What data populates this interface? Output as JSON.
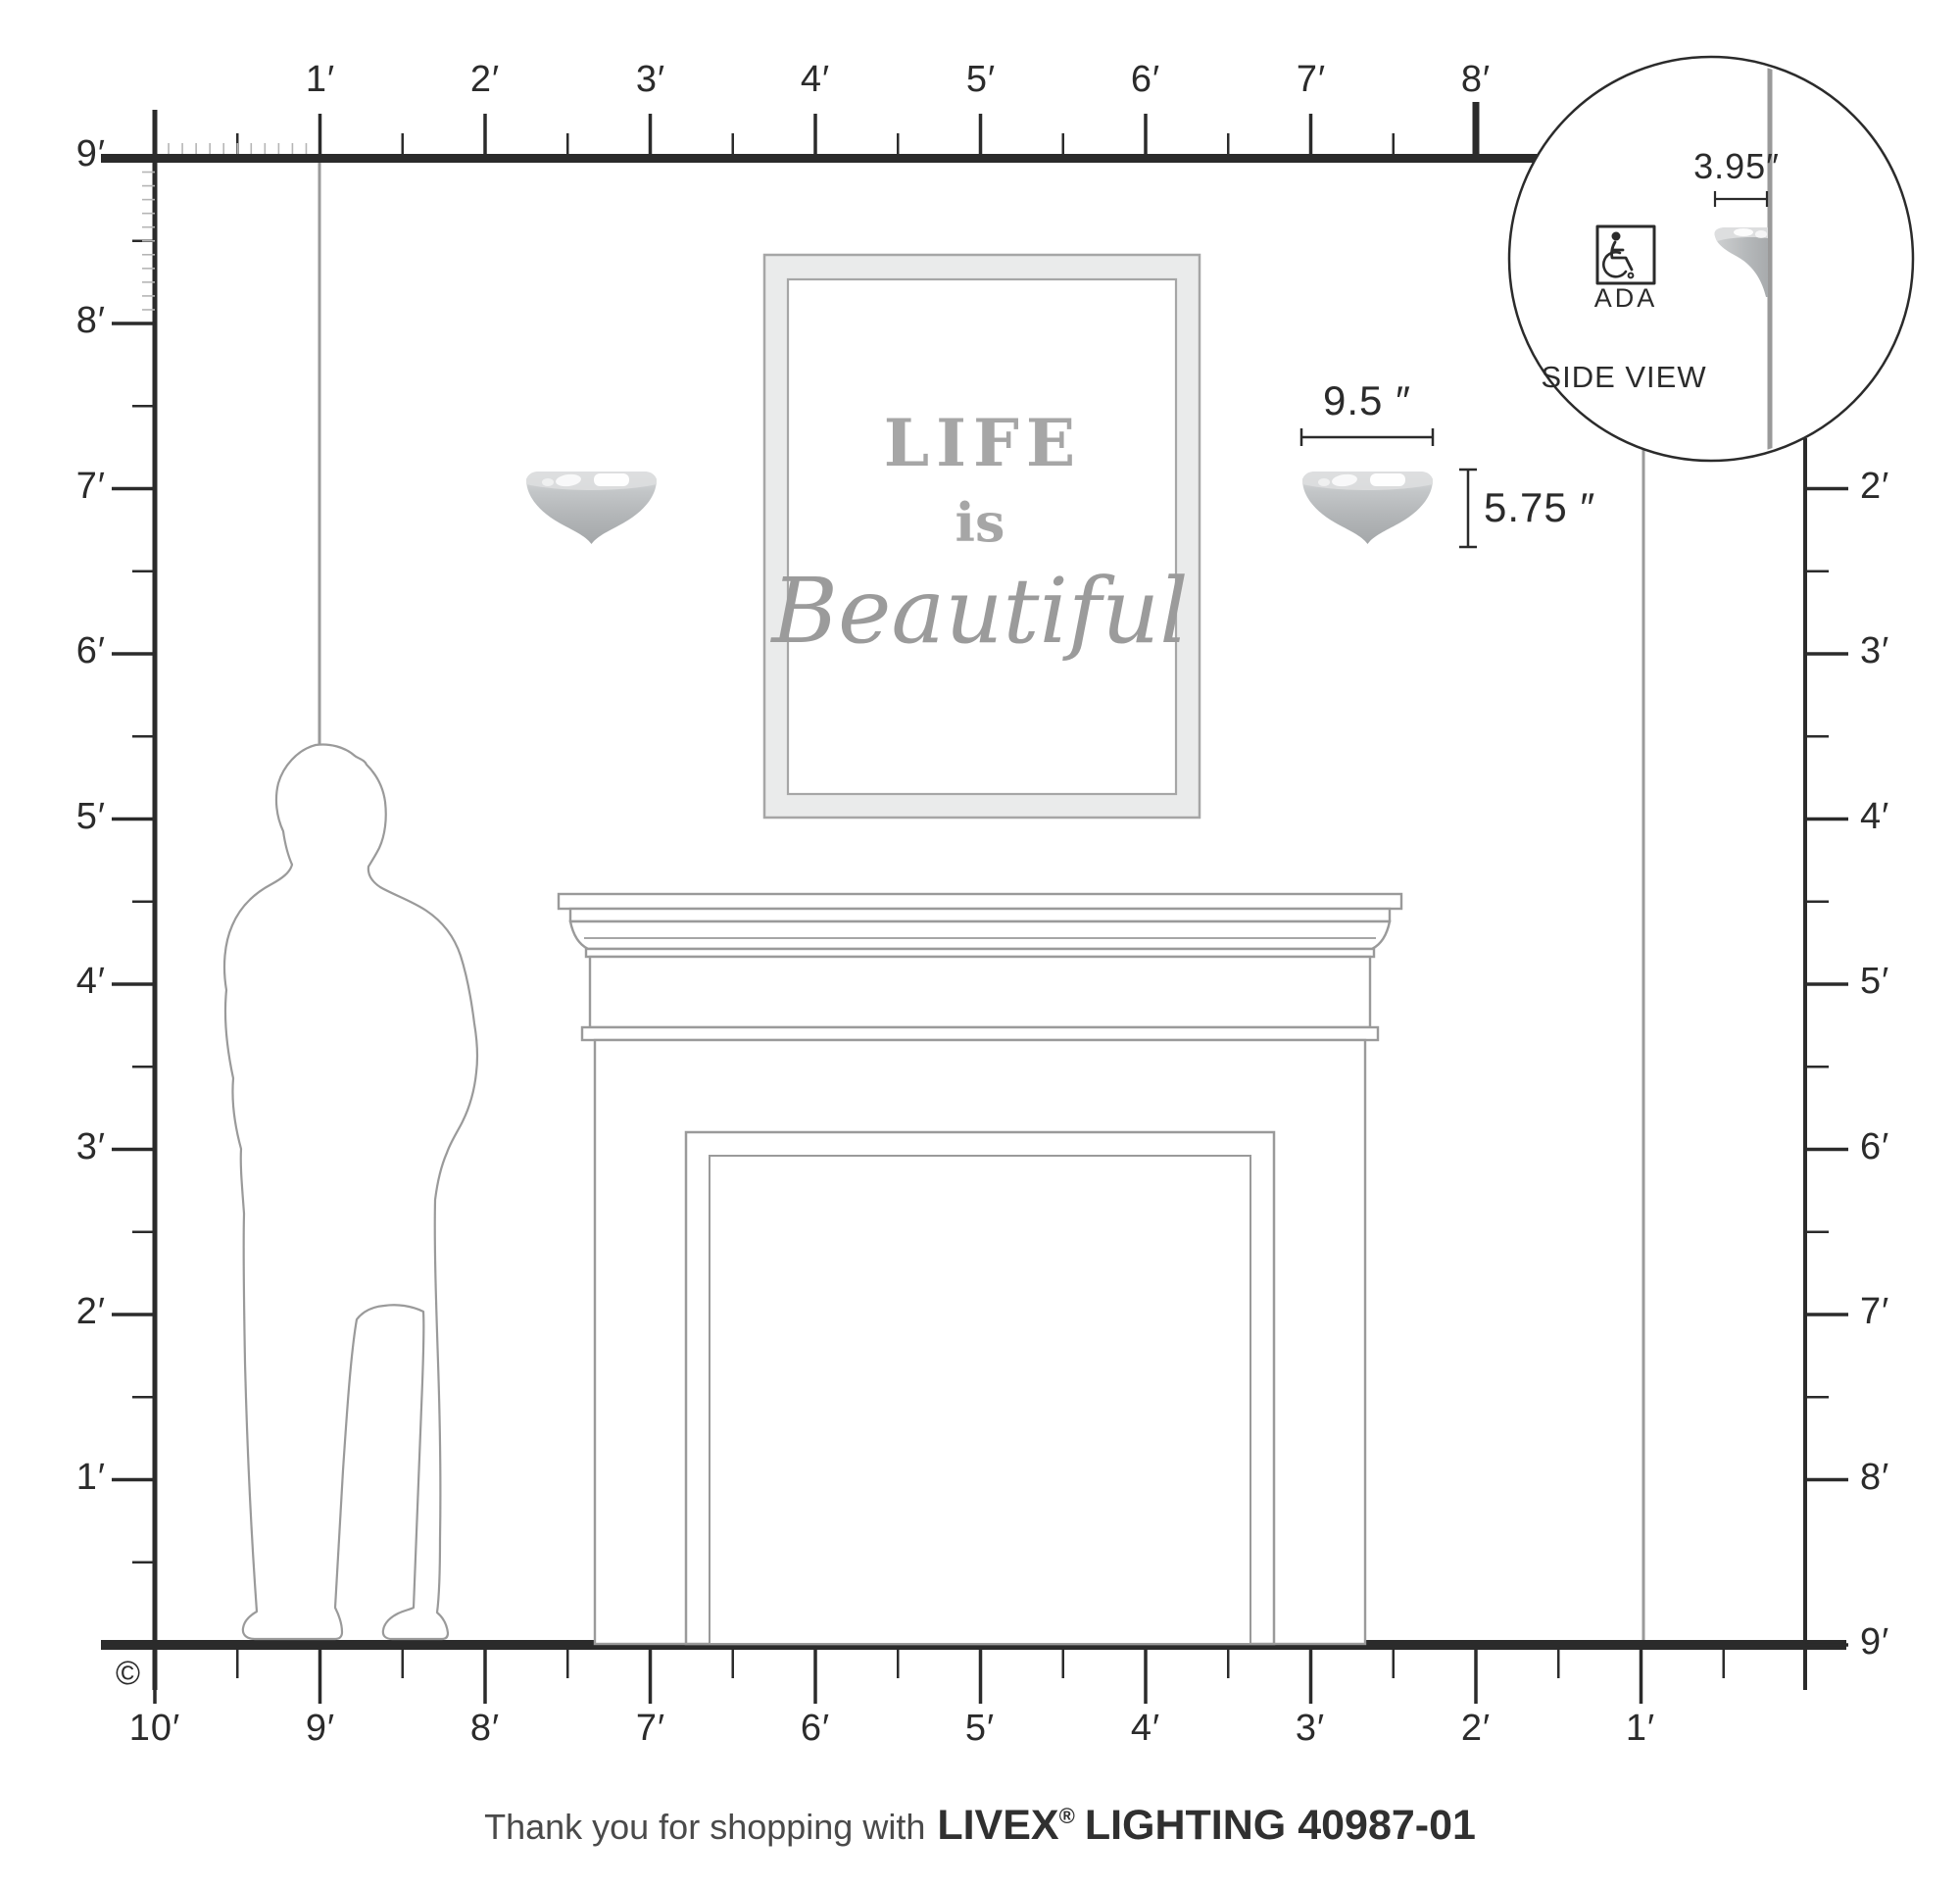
{
  "rulers": {
    "top": [
      "1′",
      "2′",
      "3′",
      "4′",
      "5′",
      "6′",
      "7′",
      "8′"
    ],
    "left": [
      "9′",
      "8′",
      "7′",
      "6′",
      "5′",
      "4′",
      "3′",
      "2′",
      "1′"
    ],
    "right": [
      "2′",
      "3′",
      "4′",
      "5′",
      "6′",
      "7′",
      "8′",
      "9′"
    ],
    "bottom": [
      "10′",
      "9′",
      "8′",
      "7′",
      "6′",
      "5′",
      "4′",
      "3′",
      "2′",
      "1′"
    ]
  },
  "sconce": {
    "width_dim": "9.5 ″",
    "height_dim": "5.75 ″"
  },
  "side_view": {
    "title": "SIDE VIEW",
    "ada_label": "ADA",
    "depth_dim": "3.95″"
  },
  "artwork": {
    "line1": "LIFE",
    "line2": "is",
    "line3": "Beautiful"
  },
  "copyright_symbol": "©",
  "footer": {
    "prefix": "Thank you for shopping with",
    "brand": "LIVEX",
    "registered": "®",
    "suffix": "LIGHTING 40987-01"
  },
  "colors": {
    "ink": "#2b2b2b",
    "line_gray": "#9a9a9a",
    "inch_tick_gray": "#b5b5b5",
    "frame_fill": "#eaebeb",
    "metal_light": "#dddedf",
    "metal_dark": "#a4a7a9"
  }
}
